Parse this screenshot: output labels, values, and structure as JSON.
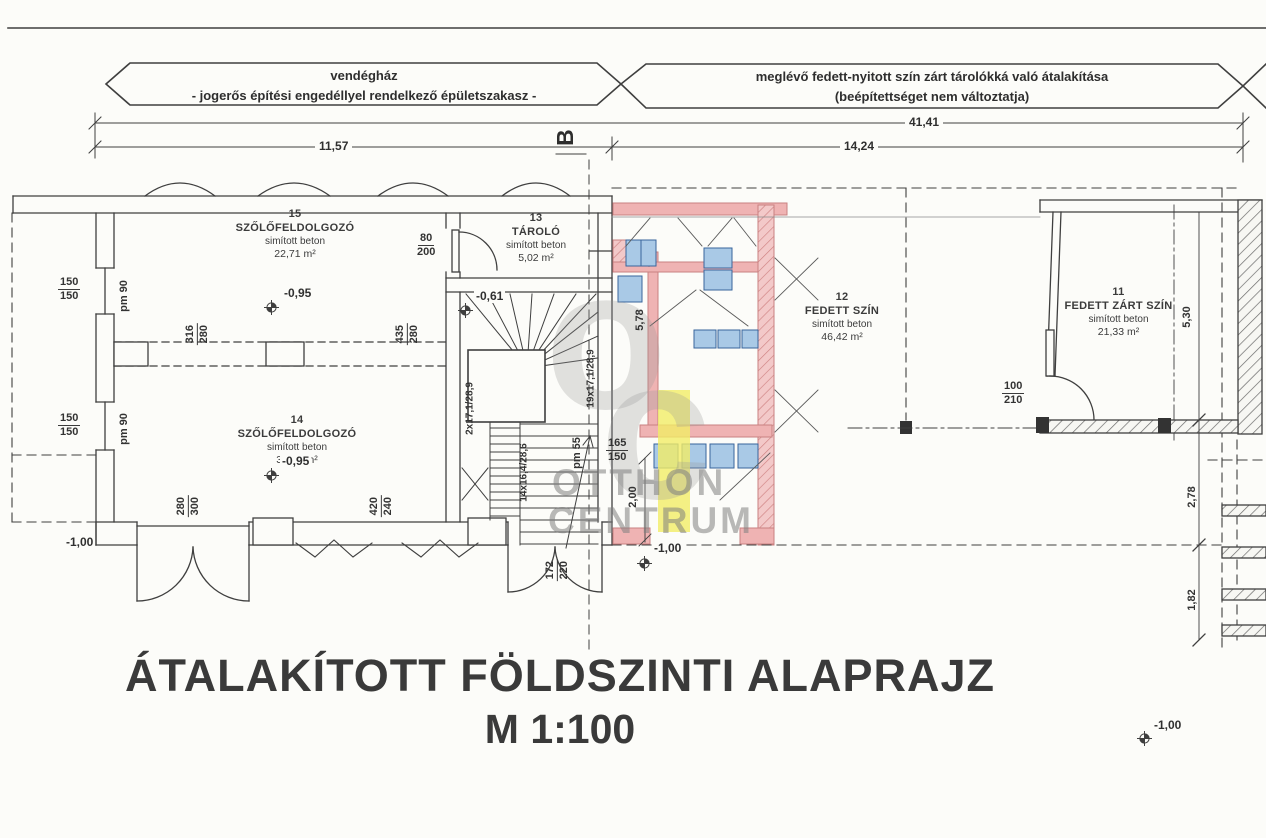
{
  "banners": {
    "left": {
      "line1": "vendégház",
      "line2": "- jogerős építési engedéllyel rendelkező épületszakasz -"
    },
    "right": {
      "line1": "meglévő fedett-nyitott szín zárt tárolókká való átalakítása",
      "line2": "(beépítettséget nem változtatja)"
    }
  },
  "dim_rows": {
    "total": "41,41",
    "left_span": "11,57",
    "right_span": "14,24",
    "section_marker": "B"
  },
  "rooms": {
    "r15": {
      "number": "15",
      "name": "SZŐLŐFELDOLGOZÓ",
      "finish": "simított beton",
      "area": "22,71 m²"
    },
    "r14": {
      "number": "14",
      "name": "SZŐLŐFELDOLGOZÓ",
      "finish": "simított beton",
      "area": "37,17 m²"
    },
    "r13": {
      "number": "13",
      "name": "TÁROLÓ",
      "finish": "simított beton",
      "area": "5,02 m²"
    },
    "r12": {
      "number": "12",
      "name": "FEDETT SZÍN",
      "finish": "simított beton",
      "area": "46,42 m²"
    },
    "r11": {
      "number": "11",
      "name": "FEDETT ZÁRT SZÍN",
      "finish": "simított beton",
      "area": "21,33 m²"
    }
  },
  "levels": {
    "room15": "-0,95",
    "room14": "-0,95",
    "stair": "-0,61",
    "bottom_left": "-1,00",
    "terrace": "-1,00",
    "yard": "-1,00"
  },
  "dims": {
    "d150a": {
      "top": "150",
      "bottom": "150"
    },
    "d150b": {
      "top": "150",
      "bottom": "150"
    },
    "pm90a": "pm 90",
    "pm90b": "pm 90",
    "pm55": "pm 55",
    "d316": {
      "top": "316",
      "bottom": "280"
    },
    "d435": {
      "top": "435",
      "bottom": "280"
    },
    "d80": {
      "top": "80",
      "bottom": "200"
    },
    "d280": {
      "top": "280",
      "bottom": "300"
    },
    "d420": {
      "top": "420",
      "bottom": "240"
    },
    "d172": {
      "top": "172",
      "bottom": "220"
    },
    "d165": {
      "top": "165",
      "bottom": "150"
    },
    "d100": {
      "top": "100",
      "bottom": "210"
    },
    "v200": "2,00",
    "v578": "5,78",
    "v530": "5,30",
    "v278": "2,78",
    "v182": "1,82",
    "stair2": "2x17,1/28,9",
    "stair19": "19x17,1/28,9",
    "stair14": "14x16,4/28,6"
  },
  "title": {
    "line1": "ÁTALAKÍTOTT FÖLDSZINTI ALAPRAJZ",
    "line2": "M  1:100"
  },
  "watermark": {
    "logo_o": "o",
    "logo_c": "c",
    "line1": "OTTHON",
    "line2": "CENTRUM"
  },
  "colors": {
    "new_wall": "#efb3b3",
    "window": "#a9c9e6",
    "highlight": "#f1ec66",
    "line": "#3f3f3f"
  }
}
